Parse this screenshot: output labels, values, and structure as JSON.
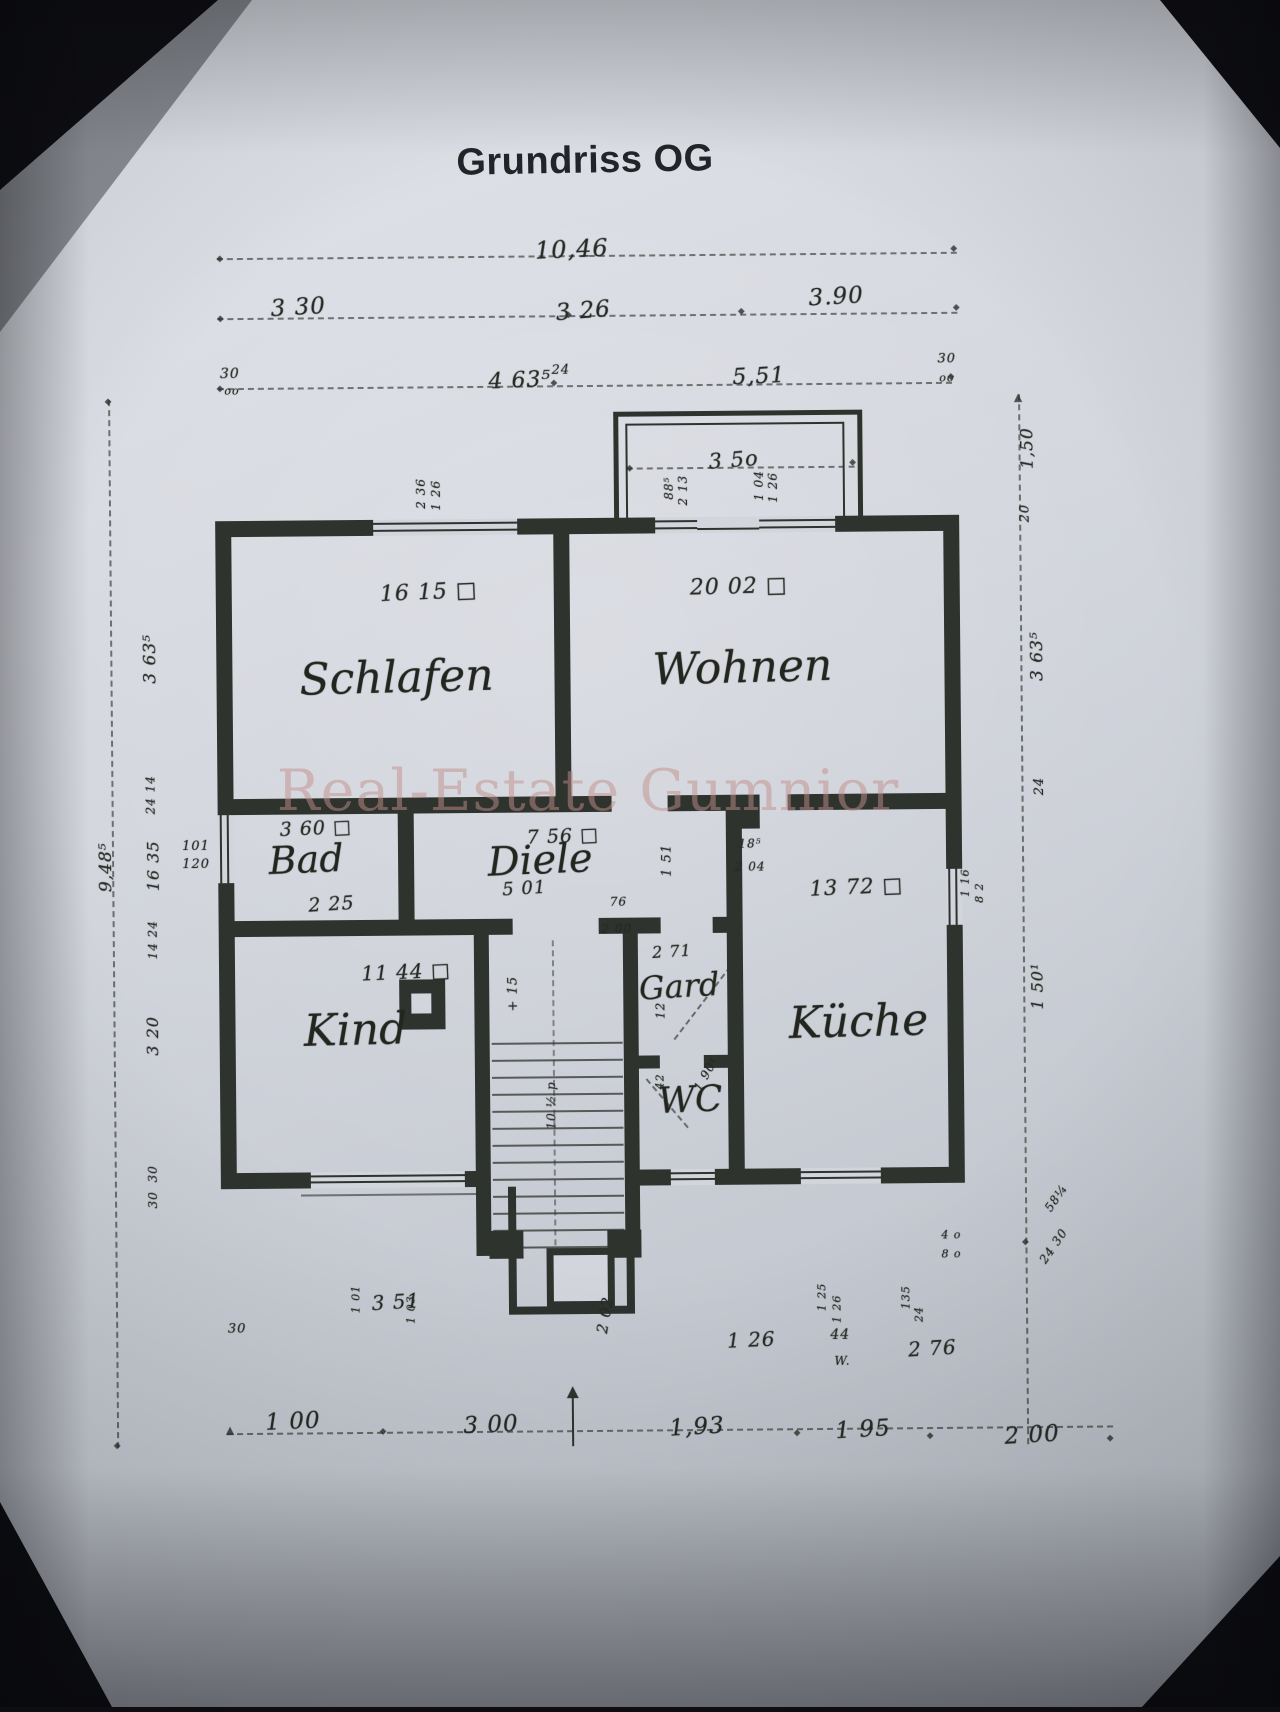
{
  "header": {
    "title": "Grundriss OG"
  },
  "watermark": {
    "text": "Real-Estate Gumnior"
  },
  "plan": {
    "rooms": [
      {
        "id": "schlafen",
        "name": "Schlafen",
        "area": "16 15 □",
        "name_pos": [
          398,
          676,
          44,
          -1
        ],
        "area_pos": [
          431,
          591,
          22,
          -2
        ]
      },
      {
        "id": "wohnen",
        "name": "Wohnen",
        "area": "20 02 □",
        "name_pos": [
          744,
          669,
          44,
          -1
        ],
        "area_pos": [
          741,
          588,
          22,
          -1
        ]
      },
      {
        "id": "bad",
        "name": "Bad",
        "area": "3 60 □",
        "name_pos": [
          306,
          857,
          38,
          -2
        ],
        "area_pos": [
          316,
          826,
          19,
          -2
        ]
      },
      {
        "id": "diele",
        "name": "Diele",
        "area": "7 56 □",
        "name_pos": [
          540,
          860,
          40,
          -2
        ],
        "area_pos": [
          563,
          836,
          19,
          -2
        ]
      },
      {
        "id": "kind",
        "name": "Kind",
        "area": "11 44 □",
        "name_pos": [
          354,
          1028,
          44,
          -1
        ],
        "area_pos": [
          405,
          970,
          20,
          -2
        ]
      },
      {
        "id": "kueche",
        "name": "Küche",
        "area": "13 72 □",
        "name_pos": [
          857,
          1024,
          44,
          -1
        ],
        "area_pos": [
          856,
          889,
          21,
          -2
        ]
      },
      {
        "id": "gard",
        "name": "Gard",
        "area": "2 71",
        "name_pos": [
          678,
          987,
          32,
          -3
        ],
        "area_pos": [
          671,
          952,
          16,
          -3
        ]
      },
      {
        "id": "wc",
        "name": "WC",
        "area": "",
        "name_pos": [
          688,
          1101,
          36,
          -2
        ],
        "area_pos": [
          688,
          1101,
          1,
          0
        ]
      }
    ],
    "dims": [
      {
        "t": "10,46",
        "x": 577,
        "y": 249,
        "fs": 24,
        "r": -2
      },
      {
        "t": "3 30",
        "x": 303,
        "y": 305,
        "fs": 23,
        "r": -3
      },
      {
        "t": "3 26",
        "x": 588,
        "y": 311,
        "fs": 23,
        "r": -4
      },
      {
        "t": "3.90",
        "x": 841,
        "y": 299,
        "fs": 23,
        "r": -3
      },
      {
        "t": "30",
        "x": 234,
        "y": 371,
        "fs": 14,
        "r": 0
      },
      {
        "t": "oo",
        "x": 236,
        "y": 388,
        "fs": 11,
        "r": 0
      },
      {
        "t": "4 63⁵",
        "x": 524,
        "y": 380,
        "fs": 22,
        "r": -2
      },
      {
        "t": "24",
        "x": 565,
        "y": 370,
        "fs": 13,
        "r": 0
      },
      {
        "t": "5,51",
        "x": 763,
        "y": 378,
        "fs": 22,
        "r": -2
      },
      {
        "t": "30",
        "x": 951,
        "y": 362,
        "fs": 13,
        "r": 0
      },
      {
        "t": "oo",
        "x": 951,
        "y": 381,
        "fs": 11,
        "r": 0
      },
      {
        "t": "3 5o",
        "x": 737,
        "y": 461,
        "fs": 21,
        "r": -4
      },
      {
        "t": "1,50",
        "x": 1031,
        "y": 452,
        "fs": 17,
        "r": -90
      },
      {
        "t": "20",
        "x": 1028,
        "y": 517,
        "fs": 13,
        "r": -90
      },
      {
        "t": "3 63⁵",
        "x": 1039,
        "y": 660,
        "fs": 17,
        "r": -90
      },
      {
        "t": "24",
        "x": 1040,
        "y": 790,
        "fs": 13,
        "r": -90
      },
      {
        "t": "1 50¹",
        "x": 1036,
        "y": 990,
        "fs": 16,
        "r": -90
      },
      {
        "t": "58¼",
        "x": 1053,
        "y": 1202,
        "fs": 12,
        "r": -55
      },
      {
        "t": "24 30",
        "x": 1050,
        "y": 1250,
        "fs": 12,
        "r": -55
      },
      {
        "t": "4 o",
        "x": 948,
        "y": 1238,
        "fs": 11,
        "r": 0
      },
      {
        "t": "8 o",
        "x": 948,
        "y": 1257,
        "fs": 11,
        "r": 0
      },
      {
        "t": "9,48⁵",
        "x": 106,
        "y": 863,
        "fs": 17,
        "r": -90
      },
      {
        "t": "3 63⁵",
        "x": 152,
        "y": 655,
        "fs": 17,
        "r": -90
      },
      {
        "t": "24 14",
        "x": 151,
        "y": 791,
        "fs": 12,
        "r": -90
      },
      {
        "t": "16 35",
        "x": 153,
        "y": 862,
        "fs": 16,
        "r": -90
      },
      {
        "t": "101",
        "x": 196,
        "y": 843,
        "fs": 13,
        "r": 0
      },
      {
        "t": "120",
        "x": 196,
        "y": 861,
        "fs": 13,
        "r": 0
      },
      {
        "t": "14 24",
        "x": 152,
        "y": 936,
        "fs": 12,
        "r": -90
      },
      {
        "t": "3 20",
        "x": 151,
        "y": 1032,
        "fs": 16,
        "r": -90
      },
      {
        "t": "30",
        "x": 150,
        "y": 1170,
        "fs": 12,
        "r": -90
      },
      {
        "t": "30",
        "x": 150,
        "y": 1196,
        "fs": 12,
        "r": -90
      },
      {
        "t": "2 36",
        "x": 424,
        "y": 492,
        "fs": 12,
        "r": -90
      },
      {
        "t": "1 26",
        "x": 439,
        "y": 494,
        "fs": 12,
        "r": -90
      },
      {
        "t": "88⁵",
        "x": 672,
        "y": 489,
        "fs": 12,
        "r": -90
      },
      {
        "t": "2 13",
        "x": 686,
        "y": 491,
        "fs": 12,
        "r": -90
      },
      {
        "t": "1 04",
        "x": 762,
        "y": 487,
        "fs": 12,
        "r": -90
      },
      {
        "t": "1 26",
        "x": 776,
        "y": 489,
        "fs": 12,
        "r": -90
      },
      {
        "t": "2 25",
        "x": 331,
        "y": 902,
        "fs": 19,
        "r": -3
      },
      {
        "t": "5 01",
        "x": 524,
        "y": 888,
        "fs": 18,
        "r": -3
      },
      {
        "t": "76",
        "x": 618,
        "y": 902,
        "fs": 12,
        "r": 0
      },
      {
        "t": "2 00",
        "x": 616,
        "y": 929,
        "fs": 12,
        "r": 0
      },
      {
        "t": "18⁵",
        "x": 750,
        "y": 845,
        "fs": 12,
        "r": 0
      },
      {
        "t": "2 04",
        "x": 750,
        "y": 868,
        "fs": 12,
        "r": 0
      },
      {
        "t": "1 51",
        "x": 667,
        "y": 861,
        "fs": 13,
        "r": -90
      },
      {
        "t": "12",
        "x": 659,
        "y": 1011,
        "fs": 12,
        "r": -90
      },
      {
        "t": "42",
        "x": 658,
        "y": 1082,
        "fs": 11,
        "r": -90
      },
      {
        "t": "1 90¹",
        "x": 704,
        "y": 1075,
        "fs": 12,
        "r": -60
      },
      {
        "t": "+ 15",
        "x": 512,
        "y": 993,
        "fs": 13,
        "r": -90
      },
      {
        "t": "10 ½ p",
        "x": 549,
        "y": 1105,
        "fs": 12,
        "r": -90
      },
      {
        "t": "1 16",
        "x": 965,
        "y": 886,
        "fs": 11,
        "r": -90
      },
      {
        "t": "8 2",
        "x": 979,
        "y": 896,
        "fs": 11,
        "r": -90
      },
      {
        "t": "3 51",
        "x": 392,
        "y": 1300,
        "fs": 20,
        "r": -3
      },
      {
        "t": "30",
        "x": 233,
        "y": 1326,
        "fs": 13,
        "r": 0
      },
      {
        "t": "1 01",
        "x": 352,
        "y": 1297,
        "fs": 11,
        "r": -90
      },
      {
        "t": "1 03",
        "x": 407,
        "y": 1308,
        "fs": 11,
        "r": -90
      },
      {
        "t": "2 02",
        "x": 601,
        "y": 1315,
        "fs": 15,
        "r": -80
      },
      {
        "t": "1 26",
        "x": 747,
        "y": 1341,
        "fs": 20,
        "r": -2
      },
      {
        "t": "44",
        "x": 836,
        "y": 1337,
        "fs": 14,
        "r": 0
      },
      {
        "t": "W.",
        "x": 838,
        "y": 1363,
        "fs": 12,
        "r": 0
      },
      {
        "t": "1 25",
        "x": 818,
        "y": 1299,
        "fs": 11,
        "r": -90
      },
      {
        "t": "1 26",
        "x": 833,
        "y": 1311,
        "fs": 11,
        "r": -90
      },
      {
        "t": "135",
        "x": 902,
        "y": 1300,
        "fs": 11,
        "r": -90
      },
      {
        "t": "24",
        "x": 915,
        "y": 1317,
        "fs": 11,
        "r": -90
      },
      {
        "t": "2 76",
        "x": 928,
        "y": 1351,
        "fs": 20,
        "r": -3
      },
      {
        "t": "1 00",
        "x": 288,
        "y": 1419,
        "fs": 23,
        "r": -2
      },
      {
        "t": "3 00",
        "x": 486,
        "y": 1424,
        "fs": 23,
        "r": -2
      },
      {
        "t": "1,93",
        "x": 692,
        "y": 1428,
        "fs": 23,
        "r": -3
      },
      {
        "t": "1 95",
        "x": 858,
        "y": 1432,
        "fs": 23,
        "r": -3
      },
      {
        "t": "2 00",
        "x": 1027,
        "y": 1439,
        "fs": 23,
        "r": -3
      }
    ],
    "ticks": [
      [
        225,
        256,
        "d"
      ],
      [
        959,
        252,
        "d"
      ],
      [
        225,
        316,
        "d"
      ],
      [
        573,
        315,
        "d"
      ],
      [
        746,
        313,
        "d"
      ],
      [
        961,
        311,
        "d"
      ],
      [
        224,
        386,
        "d"
      ],
      [
        558,
        383,
        "d"
      ],
      [
        955,
        380,
        "d"
      ],
      [
        633,
        469,
        "d"
      ],
      [
        856,
        465,
        "d"
      ],
      [
        112,
        398,
        "d"
      ],
      [
        112,
        1442,
        "d"
      ],
      [
        1022,
        401,
        "u"
      ],
      [
        1022,
        1246,
        "d"
      ],
      [
        225,
        1427,
        "u"
      ],
      [
        378,
        1430,
        "d"
      ],
      [
        792,
        1435,
        "d"
      ],
      [
        925,
        1439,
        "d"
      ],
      [
        1105,
        1443,
        "d"
      ]
    ]
  }
}
